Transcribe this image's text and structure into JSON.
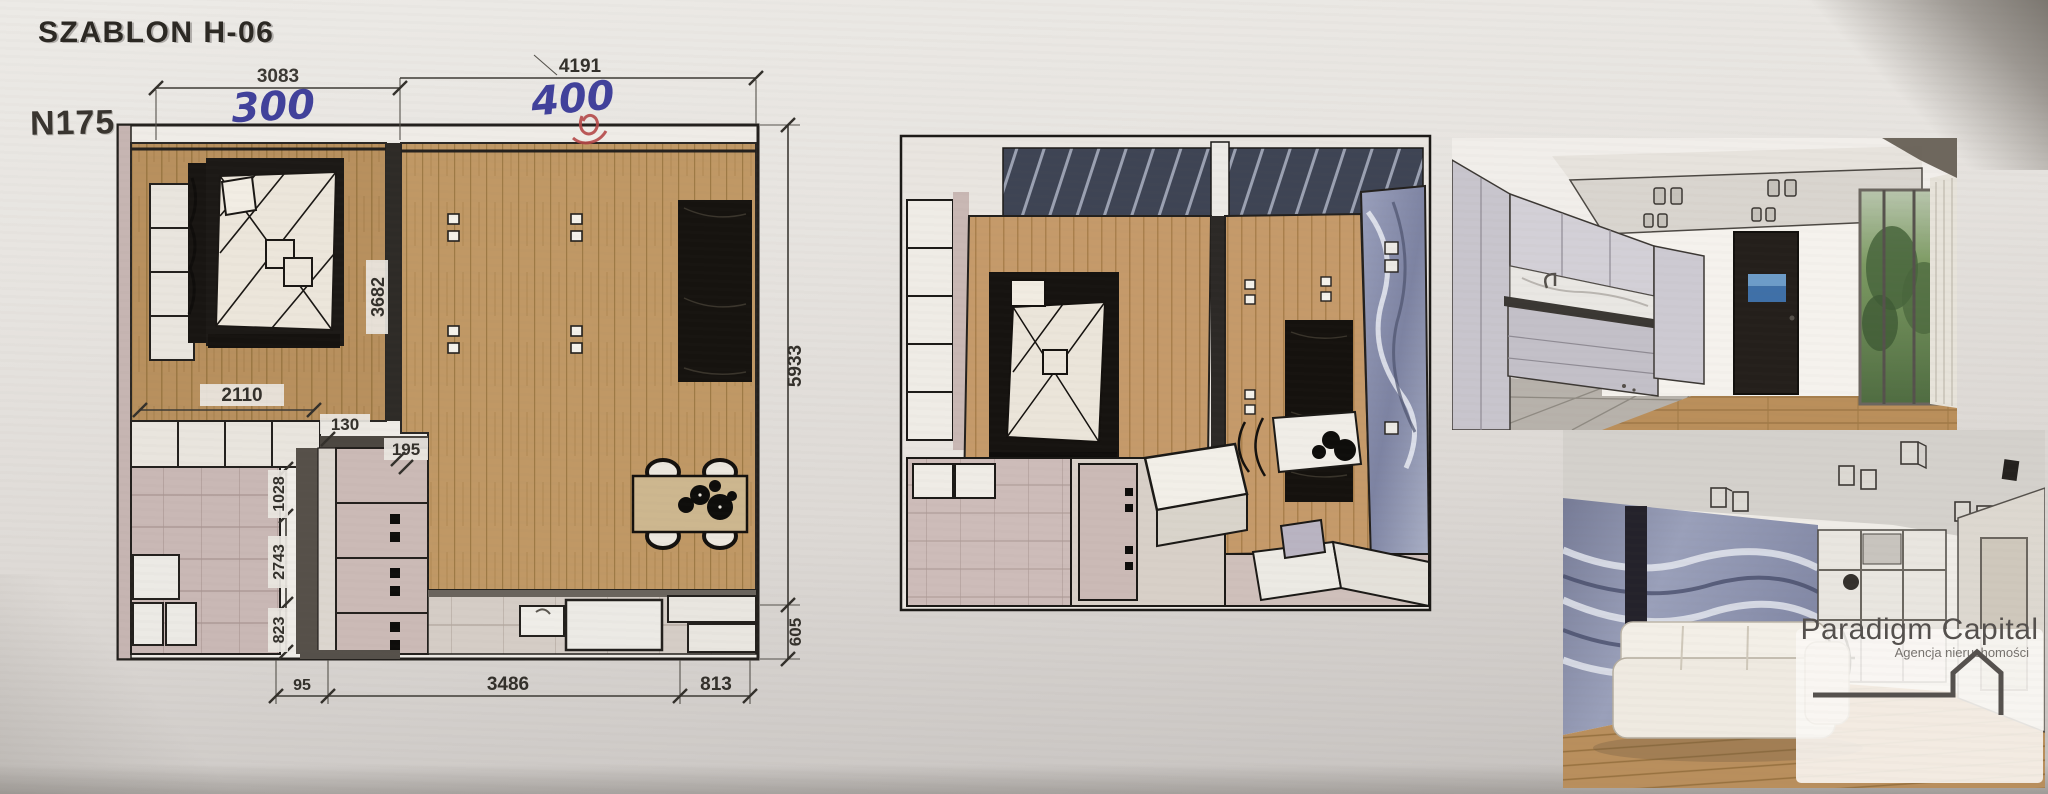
{
  "document": {
    "template_label": "SZABLON H-06",
    "plan_number": "N175"
  },
  "floor_plan": {
    "dims": {
      "top_left_width": "3083",
      "top_right_width": "4191",
      "hand_left": "300",
      "hand_right": "400",
      "right_height": "5933",
      "right_height_lower": "605",
      "bottom_small": "95",
      "bottom_width": "3486",
      "bottom_right_width": "813",
      "bedroom_depth": "3682",
      "closet_row_width": "2110",
      "wall_thickness": "130",
      "door_gap": "195",
      "hall_upper": "1028",
      "hall_mid": "2743",
      "hall_lower": "823"
    }
  },
  "logo": {
    "name": "Paradigm Capital",
    "subtitle": "Agencja nieruchomości"
  },
  "colors": {
    "paper": "#e7e4e0",
    "wood": "#b8905e",
    "wood_light": "#c29a68",
    "tile_mauve": "#c9b8b5",
    "tile_light": "#d6cec7",
    "line_dark": "#23201d",
    "marble_blue": "#8b90ac",
    "handwriting_blue": "#41419b",
    "handwriting_red": "#b54848"
  }
}
